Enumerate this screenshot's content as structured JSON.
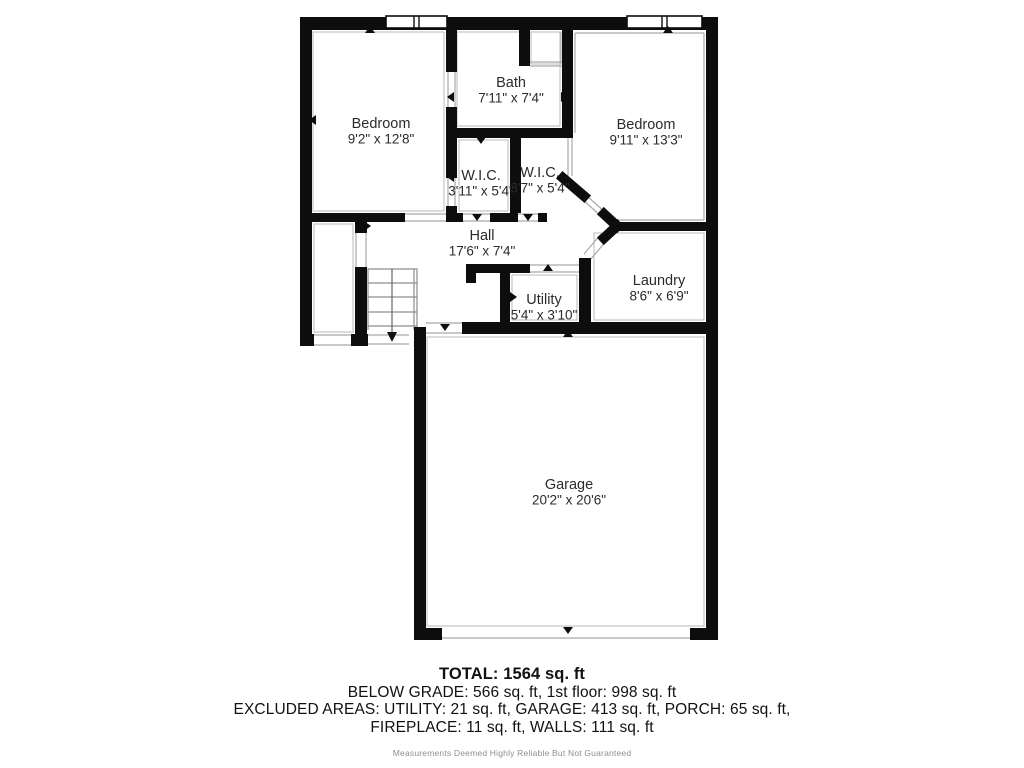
{
  "colors": {
    "wall": "#0d0d0d",
    "thin": "#a9a9a9",
    "inset": "#b8b8b8",
    "label": "#2b2b2b",
    "stair": "#8d8d8d"
  },
  "floorplan": {
    "canvas": {
      "width": 1024,
      "height": 768
    },
    "walls": [
      [
        300,
        17,
        418,
        13
      ],
      [
        300,
        17,
        12,
        329
      ],
      [
        706,
        17,
        12,
        623
      ],
      [
        300,
        334,
        14,
        12
      ],
      [
        351,
        334,
        17,
        12
      ],
      [
        355,
        213,
        12,
        20
      ],
      [
        355,
        267,
        12,
        79
      ],
      [
        414,
        327,
        12,
        313
      ],
      [
        462,
        322,
        244,
        12
      ],
      [
        414,
        628,
        28,
        12
      ],
      [
        690,
        628,
        28,
        12
      ],
      [
        446,
        30,
        11,
        42
      ],
      [
        446,
        107,
        11,
        71
      ],
      [
        446,
        206,
        11,
        16
      ],
      [
        446,
        128,
        127,
        10
      ],
      [
        519,
        30,
        11,
        36
      ],
      [
        562,
        30,
        11,
        98
      ],
      [
        510,
        138,
        11,
        75
      ],
      [
        300,
        213,
        105,
        9
      ],
      [
        446,
        213,
        17,
        9
      ],
      [
        490,
        213,
        28,
        9
      ],
      [
        538,
        213,
        9,
        9
      ],
      [
        614,
        222,
        92,
        9
      ],
      [
        579,
        258,
        12,
        64
      ],
      [
        466,
        264,
        64,
        9
      ],
      [
        466,
        264,
        10,
        19
      ],
      [
        500,
        264,
        10,
        58
      ]
    ],
    "diag_walls": [
      [
        563,
        178,
        584,
        196
      ],
      [
        604,
        214,
        617,
        226
      ],
      [
        604,
        238,
        617,
        226
      ]
    ],
    "thin_lines": [
      [
        405,
        214,
        446,
        214
      ],
      [
        405,
        221,
        446,
        221
      ],
      [
        448,
        72,
        448,
        107
      ],
      [
        455,
        72,
        455,
        107
      ],
      [
        448,
        178,
        448,
        206
      ],
      [
        455,
        178,
        455,
        206
      ],
      [
        463,
        214,
        490,
        214
      ],
      [
        463,
        221,
        490,
        221
      ],
      [
        518,
        214,
        538,
        214
      ],
      [
        518,
        221,
        538,
        221
      ],
      [
        568,
        138,
        568,
        176
      ],
      [
        572,
        138,
        572,
        176
      ],
      [
        530,
        62,
        562,
        62
      ],
      [
        530,
        66,
        562,
        66
      ],
      [
        586,
        195,
        607,
        214
      ],
      [
        582,
        199,
        603,
        218
      ],
      [
        601,
        234,
        584,
        254
      ],
      [
        607,
        240,
        590,
        260
      ],
      [
        530,
        265,
        579,
        265
      ],
      [
        530,
        272,
        579,
        272
      ],
      [
        356,
        233,
        356,
        267
      ],
      [
        366,
        233,
        366,
        267
      ],
      [
        314,
        335,
        351,
        335
      ],
      [
        314,
        345,
        351,
        345
      ],
      [
        367,
        335,
        409,
        335
      ],
      [
        367,
        344,
        409,
        344
      ],
      [
        426,
        323,
        462,
        323
      ],
      [
        426,
        333,
        462,
        333
      ],
      [
        442,
        638,
        690,
        638
      ],
      [
        575,
        33,
        704,
        33
      ],
      [
        704,
        33,
        704,
        220
      ],
      [
        616,
        220,
        704,
        220
      ],
      [
        575,
        33,
        575,
        133
      ]
    ],
    "thin_rects": [
      [
        313,
        32,
        131,
        179
      ],
      [
        457,
        32,
        103,
        94
      ],
      [
        531,
        32,
        30,
        32
      ],
      [
        594,
        233,
        110,
        87
      ],
      [
        512,
        275,
        65,
        45
      ],
      [
        427,
        337,
        277,
        289
      ],
      [
        314,
        224,
        39,
        108
      ],
      [
        459,
        140,
        49,
        71
      ]
    ],
    "windows": [
      {
        "x": 386,
        "y": 16,
        "w": 61,
        "h": 12,
        "mullions": [
          414,
          419
        ]
      },
      {
        "x": 627,
        "y": 16,
        "w": 75,
        "h": 12,
        "mullions": [
          662,
          667
        ]
      }
    ],
    "stairs": {
      "x": 368,
      "y": 269,
      "w": 49,
      "h": 61,
      "steps": [
        283,
        297,
        312,
        326
      ],
      "inner_x": 414,
      "center_x": 392,
      "arrow_y": 342
    },
    "ticks": [
      [
        370,
        30,
        "up"
      ],
      [
        668,
        30,
        "up"
      ],
      [
        548,
        268,
        "up"
      ],
      [
        568,
        334,
        "up"
      ],
      [
        481,
        140,
        "down"
      ],
      [
        378,
        216,
        "down"
      ],
      [
        477,
        217,
        "down"
      ],
      [
        528,
        217,
        "down"
      ],
      [
        667,
        226,
        "down"
      ],
      [
        445,
        327,
        "down"
      ],
      [
        548,
        327,
        "down"
      ],
      [
        668,
        327,
        "down"
      ],
      [
        568,
        630,
        "down"
      ],
      [
        313,
        120,
        "left"
      ],
      [
        451,
        97,
        "left"
      ],
      [
        451,
        177,
        "left"
      ],
      [
        583,
        297,
        "left"
      ],
      [
        420,
        483,
        "left"
      ],
      [
        711,
        105,
        "right"
      ],
      [
        711,
        297,
        "right"
      ],
      [
        711,
        483,
        "right"
      ],
      [
        513,
        297,
        "right"
      ],
      [
        564,
        97,
        "right"
      ],
      [
        367,
        226,
        "right"
      ]
    ],
    "rooms": [
      {
        "name": "Bedroom",
        "dims": "9'2\" x 12'8\"",
        "x": 381,
        "y": 124
      },
      {
        "name": "Bath",
        "dims": "7'11\" x 7'4\"",
        "x": 511,
        "y": 83
      },
      {
        "name": "Bedroom",
        "dims": "9'11\" x 13'3\"",
        "x": 646,
        "y": 125
      },
      {
        "name": "W.I.C.",
        "dims": "3'11\" x 5'4\"",
        "x": 481,
        "y": 176
      },
      {
        "name": "W.I.C.",
        "dims": "3'7\" x 5'4\"",
        "x": 540,
        "y": 173
      },
      {
        "name": "Hall",
        "dims": "17'6\" x 7'4\"",
        "x": 482,
        "y": 236
      },
      {
        "name": "Laundry",
        "dims": "8'6\" x 6'9\"",
        "x": 659,
        "y": 281
      },
      {
        "name": "Utility",
        "dims": "5'4\" x 3'10\"",
        "x": 544,
        "y": 300
      },
      {
        "name": "Garage",
        "dims": "20'2\" x 20'6\"",
        "x": 569,
        "y": 485
      }
    ]
  },
  "summary": {
    "total": "TOTAL: 1564 sq. ft",
    "below_grade": "BELOW GRADE: 566 sq. ft, 1st floor: 998 sq. ft",
    "excluded": "EXCLUDED AREAS: UTILITY: 21 sq. ft, GARAGE: 413 sq. ft, PORCH: 65 sq. ft,",
    "excluded2": "FIREPLACE: 11 sq. ft, WALLS: 111 sq. ft",
    "disclaimer": "Measurements Deemed Highly Reliable But Not Guaranteed"
  }
}
